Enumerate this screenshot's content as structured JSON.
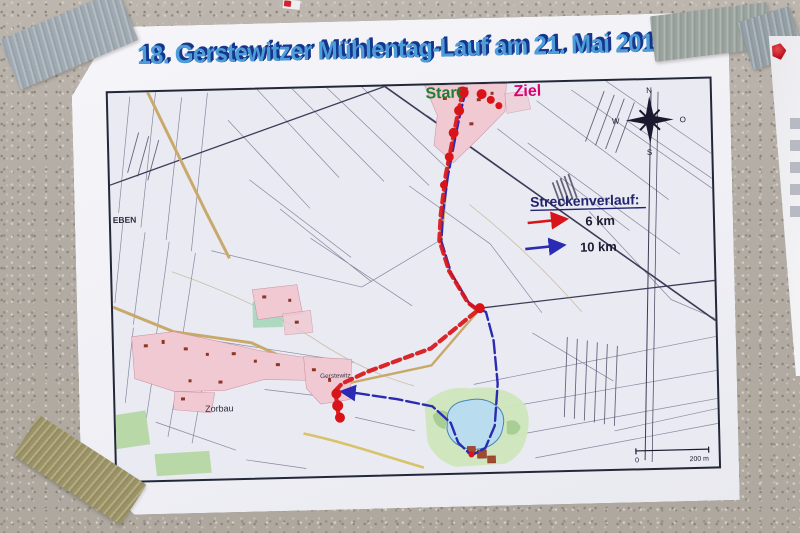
{
  "poster": {
    "title": "18. Gerstewitzer Mühlentag-Lauf am 21. Mai 2018"
  },
  "map": {
    "labels": {
      "start": "Start",
      "ziel": "Ziel",
      "eben": "EBEN",
      "zorbau": "Zorbau",
      "gerstewitz": "Gerstewitz"
    },
    "legend": {
      "heading": "Streckenverlauf:",
      "routes": [
        {
          "label": "6 km",
          "color": "#d81418"
        },
        {
          "label": "10 km",
          "color": "#2a2ab2"
        }
      ]
    },
    "compass": {
      "n": "N",
      "e": "O",
      "s": "S",
      "w": "W"
    },
    "scale": {
      "zero": "0",
      "distance": "200 m"
    },
    "colors": {
      "start_label": "#1f7e31",
      "ziel_label": "#db0070",
      "legend_heading": "#23246e",
      "title_fill": "#4d9dd8",
      "title_shadow": "#16368e"
    }
  }
}
